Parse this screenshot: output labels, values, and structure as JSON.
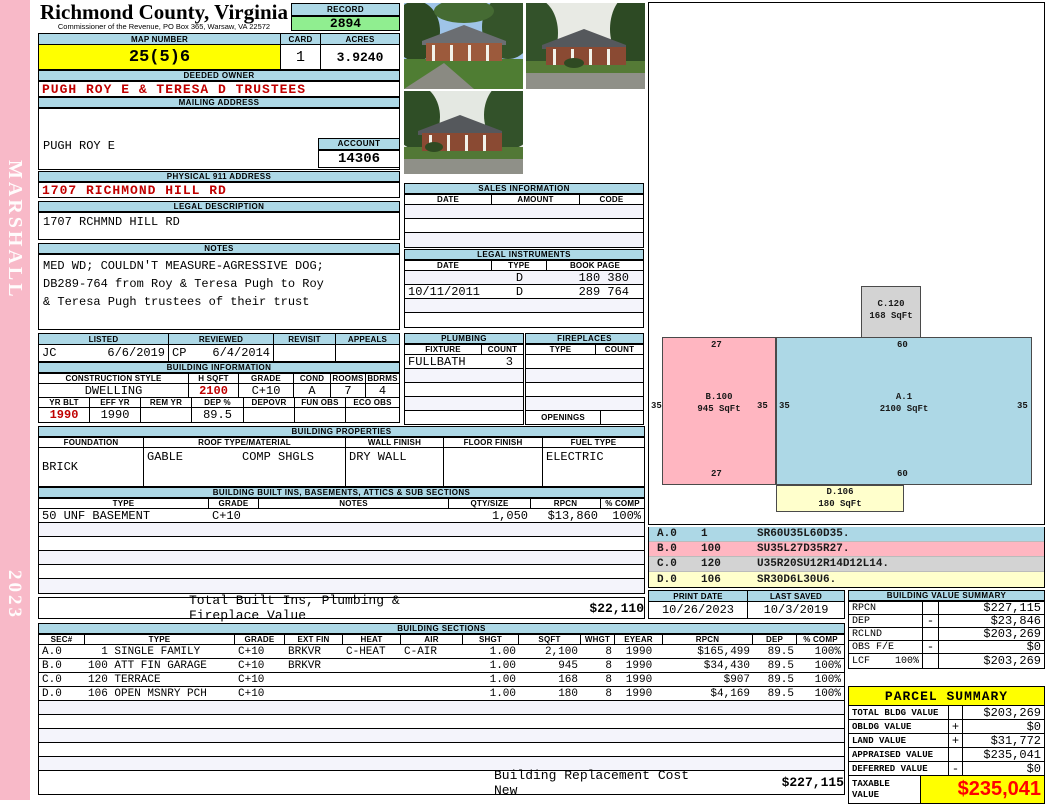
{
  "sidebar": {
    "vendor": "MARSHALL",
    "year": "2023"
  },
  "header": {
    "county_title": "Richmond County, Virginia",
    "county_subtitle": "Commissioner of the Revenue, PO Box 365, Warsaw, VA 22572",
    "record_label": "RECORD",
    "record_value": "2894",
    "map_label": "MAP NUMBER",
    "map_value": "25(5)6",
    "card_label": "CARD",
    "card_value": "1",
    "acres_label": "ACRES",
    "acres_value": "3.9240"
  },
  "owner": {
    "label": "DEEDED OWNER",
    "value": "PUGH ROY E & TERESA D TRUSTEES"
  },
  "mailing": {
    "label": "MAILING ADDRESS",
    "line1": "PUGH ROY E",
    "line2": "PO BOX  1417",
    "line3": "WARSAW, VA 22572-0000"
  },
  "account": {
    "label": "ACCOUNT",
    "value": "14306"
  },
  "physical": {
    "label": "PHYSICAL 911 ADDRESS",
    "value": "1707 RICHMOND HILL RD"
  },
  "legal": {
    "label": "LEGAL DESCRIPTION",
    "value": "1707 RCHMND HILL RD"
  },
  "notes": {
    "label": "NOTES",
    "line1": "MED WD; COULDN'T MEASURE-AGRESSIVE DOG;",
    "line2": "DB289-764 from Roy & Teresa Pugh to Roy",
    "line3": "& Teresa Pugh trustees of their trust"
  },
  "review": {
    "headers": [
      "LISTED",
      "REVIEWED",
      "REVISIT",
      "APPEALS"
    ],
    "listed_by": "JC",
    "listed_date": "6/6/2019",
    "reviewed_by": "CP",
    "reviewed_date": "6/4/2014",
    "revisit": "",
    "appeals": ""
  },
  "building_info": {
    "title": "BUILDING INFORMATION",
    "row1_headers": [
      "CONSTRUCTION STYLE",
      "H SQFT",
      "GRADE",
      "COND",
      "ROOMS",
      "BDRMS"
    ],
    "style": "DWELLING",
    "hsqft": "2100",
    "grade": "C+10",
    "cond": "A",
    "rooms": "7",
    "bdrms": "4",
    "row2_headers": [
      "YR BLT",
      "EFF YR",
      "REM YR",
      "DEP %",
      "DEPOVR",
      "FUN OBS",
      "ECO OBS"
    ],
    "yr_blt": "1990",
    "eff_yr": "1990",
    "rem_yr": "",
    "dep_pct": "89.5",
    "depovr": "",
    "fun_obs": "",
    "eco_obs": ""
  },
  "building_properties": {
    "title": "BUILDING PROPERTIES",
    "headers": [
      "FOUNDATION",
      "ROOF TYPE/MATERIAL",
      "WALL FINISH",
      "FLOOR FINISH",
      "FUEL TYPE"
    ],
    "foundation": "BRICK",
    "roof_type": "GABLE",
    "roof_material": "COMP SHGLS",
    "wall_finish": "DRY WALL",
    "floor_finish": "",
    "fuel_type": "ELECTRIC"
  },
  "built_ins": {
    "title": "BUILDING BUILT INS, BASEMENTS, ATTICS & SUB SECTIONS",
    "headers": [
      "TYPE",
      "GRADE",
      "NOTES",
      "QTY/SIZE",
      "RPCN",
      "% COMP"
    ],
    "rows": [
      {
        "type": "50 UNF BASEMENT",
        "grade": "C+10",
        "notes": "",
        "qty": "1,050",
        "rpcn": "$13,860",
        "comp": "100%"
      }
    ],
    "total_label": "Total Built Ins, Plumbing & Fireplace Value",
    "total_value": "$22,110"
  },
  "sales": {
    "title": "SALES INFORMATION",
    "headers": [
      "DATE",
      "AMOUNT",
      "CODE"
    ]
  },
  "instruments": {
    "title": "LEGAL INSTRUMENTS",
    "headers": [
      "DATE",
      "TYPE",
      "BOOK PAGE"
    ],
    "rows": [
      {
        "date": "",
        "type": "D",
        "book_page": "180 380"
      },
      {
        "date": "10/11/2011",
        "type": "D",
        "book_page": "289 764"
      }
    ]
  },
  "plumbing": {
    "title": "PLUMBING",
    "headers": [
      "FIXTURE",
      "COUNT"
    ],
    "rows": [
      {
        "fixture": "FULLBATH",
        "count": "3"
      }
    ]
  },
  "fireplaces": {
    "title": "FIREPLACES",
    "headers": [
      "TYPE",
      "COUNT"
    ],
    "openings_label": "OPENINGS"
  },
  "sketch": {
    "areas": [
      {
        "id": "A.1",
        "sqft": "2100 SqFt",
        "top": "60",
        "bottom": "60",
        "left": "35",
        "right": "35"
      },
      {
        "id": "B.100",
        "sqft": "945 SqFt",
        "top": "27",
        "bottom": "27",
        "left": "35",
        "right": "35"
      },
      {
        "id": "C.120",
        "sqft": "168 SqFt"
      },
      {
        "id": "D.106",
        "sqft": "180 SqFt"
      }
    ],
    "legend": [
      {
        "code": "A.0",
        "qty": "1",
        "vector": "SR60U35L60D35."
      },
      {
        "code": "B.0",
        "qty": "100",
        "vector": "SU35L27D35R27."
      },
      {
        "code": "C.0",
        "qty": "120",
        "vector": "U35R20SU12R14D12L14."
      },
      {
        "code": "D.0",
        "qty": "106",
        "vector": "SR30D6L30U6."
      }
    ]
  },
  "dates": {
    "print_label": "PRINT DATE",
    "print_value": "10/26/2023",
    "saved_label": "LAST SAVED",
    "saved_value": "10/3/2019"
  },
  "value_summary": {
    "title": "BUILDING VALUE SUMMARY",
    "rows": [
      {
        "label": "RPCN",
        "sign": "",
        "value": "$227,115"
      },
      {
        "label": "DEP",
        "sign": "-",
        "value": "$23,846"
      },
      {
        "label": "RCLND",
        "sign": "",
        "value": "$203,269"
      },
      {
        "label": "OBS F/E",
        "sign": "-",
        "value": "$0"
      },
      {
        "label": "LCF",
        "pct": "100%",
        "sign": "",
        "value": "$203,269"
      }
    ]
  },
  "building_sections": {
    "title": "BUILDING SECTIONS",
    "headers": [
      "SEC#",
      "TYPE",
      "GRADE",
      "EXT FIN",
      "HEAT",
      "AIR",
      "SHGT",
      "SQFT",
      "WHGT",
      "EYEAR",
      "RPCN",
      "DEP",
      "% COMP"
    ],
    "rows": [
      {
        "sec": "A.0",
        "type": "  1 SINGLE FAMILY",
        "grade": "C+10",
        "ext": "BRKVR",
        "heat": "C-HEAT",
        "air": "C-AIR",
        "shgt": "1.00",
        "sqft": "2,100",
        "whgt": "8",
        "eyear": "1990",
        "rpcn": "$165,499",
        "dep": "89.5",
        "comp": "100%"
      },
      {
        "sec": "B.0",
        "type": "100 ATT FIN GARAGE",
        "grade": "C+10",
        "ext": "BRKVR",
        "heat": "",
        "air": "",
        "shgt": "1.00",
        "sqft": "945",
        "whgt": "8",
        "eyear": "1990",
        "rpcn": "$34,430",
        "dep": "89.5",
        "comp": "100%"
      },
      {
        "sec": "C.0",
        "type": "120 TERRACE",
        "grade": "C+10",
        "ext": "",
        "heat": "",
        "air": "",
        "shgt": "1.00",
        "sqft": "168",
        "whgt": "8",
        "eyear": "1990",
        "rpcn": "$907",
        "dep": "89.5",
        "comp": "100%"
      },
      {
        "sec": "D.0",
        "type": "106 OPEN MSNRY PCH",
        "grade": "C+10",
        "ext": "",
        "heat": "",
        "air": "",
        "shgt": "1.00",
        "sqft": "180",
        "whgt": "8",
        "eyear": "1990",
        "rpcn": "$4,169",
        "dep": "89.5",
        "comp": "100%"
      }
    ],
    "replacement_label": "Building Replacement Cost New",
    "replacement_value": "$227,115"
  },
  "parcel_summary": {
    "title": "PARCEL SUMMARY",
    "rows": [
      {
        "label": "TOTAL BLDG VALUE",
        "sign": "",
        "value": "$203,269"
      },
      {
        "label": "OBLDG VALUE",
        "sign": "+",
        "value": "$0"
      },
      {
        "label": "LAND VALUE",
        "sign": "+",
        "value": "$31,772"
      },
      {
        "label": "APPRAISED VALUE",
        "sign": "",
        "value": "$235,041"
      },
      {
        "label": "DEFERRED VALUE",
        "sign": "-",
        "value": "$0"
      }
    ],
    "taxable_label": "TAXABLE VALUE",
    "taxable_value": "$235,041"
  },
  "colors": {
    "header_strip": "#ADD8E6",
    "record_green": "#90EE90",
    "highlight_yellow": "#FFFF00",
    "sidebar_pink": "#F8B9C8",
    "accent_red": "#C00000",
    "taxable_red": "#FF0000",
    "sketch_a_blue": "#ADD8E6",
    "sketch_b_pink": "#FFB6C1",
    "sketch_c_grey": "#D3D3D3",
    "sketch_d_yellow": "#FFFFCC"
  }
}
